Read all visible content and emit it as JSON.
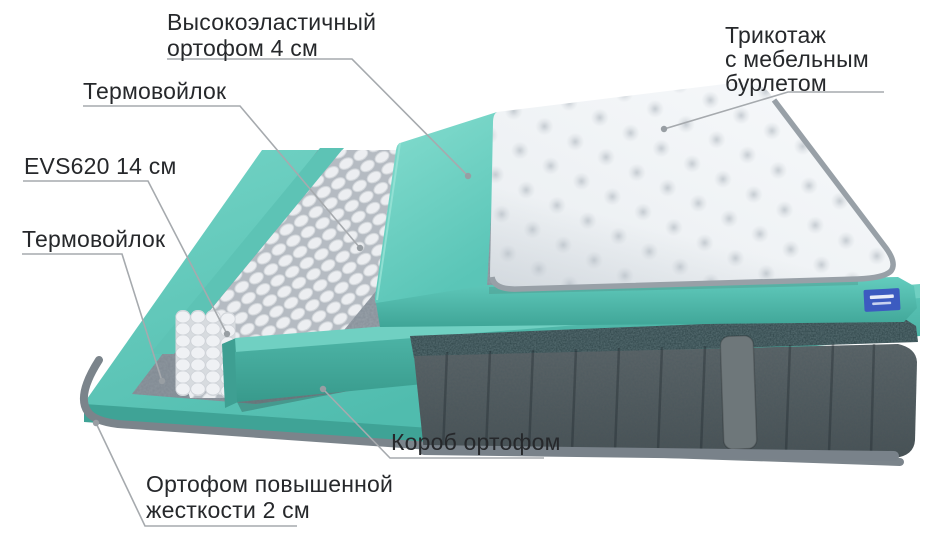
{
  "diagram": {
    "background": "#ffffff",
    "labels": [
      {
        "id": "knit-cover",
        "lines": [
          "Трикотаж",
          "с мебельным",
          "бурлетом"
        ]
      },
      {
        "id": "highelastic-foam",
        "lines": [
          "Высокоэластичный",
          "ортофом 4 см"
        ]
      },
      {
        "id": "thermofelt-top",
        "lines": [
          "Термовойлок"
        ]
      },
      {
        "id": "spring-block",
        "lines": [
          "EVS620 14 см"
        ]
      },
      {
        "id": "thermofelt-bottom",
        "lines": [
          "Термовойлок"
        ]
      },
      {
        "id": "foam-box",
        "lines": [
          "Короб ортофом"
        ]
      },
      {
        "id": "hard-foam",
        "lines": [
          "Ортофом повышенной",
          "жесткости 2 см"
        ]
      }
    ],
    "colors": {
      "foam_teal": "#64cbbd",
      "foam_teal_dark": "#3fa99b",
      "felt_gray": "#929ba3",
      "springs_white": "#eef0f2",
      "velour_gray": "#545d60",
      "velour_top_band": "#2c4246",
      "quilt_white": "#f3f5f7",
      "piping_gray": "#7b848b",
      "leader_line": "#a6aaae",
      "label_text": "#26282b",
      "brand_tag_blue": "#3c5bc0"
    }
  }
}
